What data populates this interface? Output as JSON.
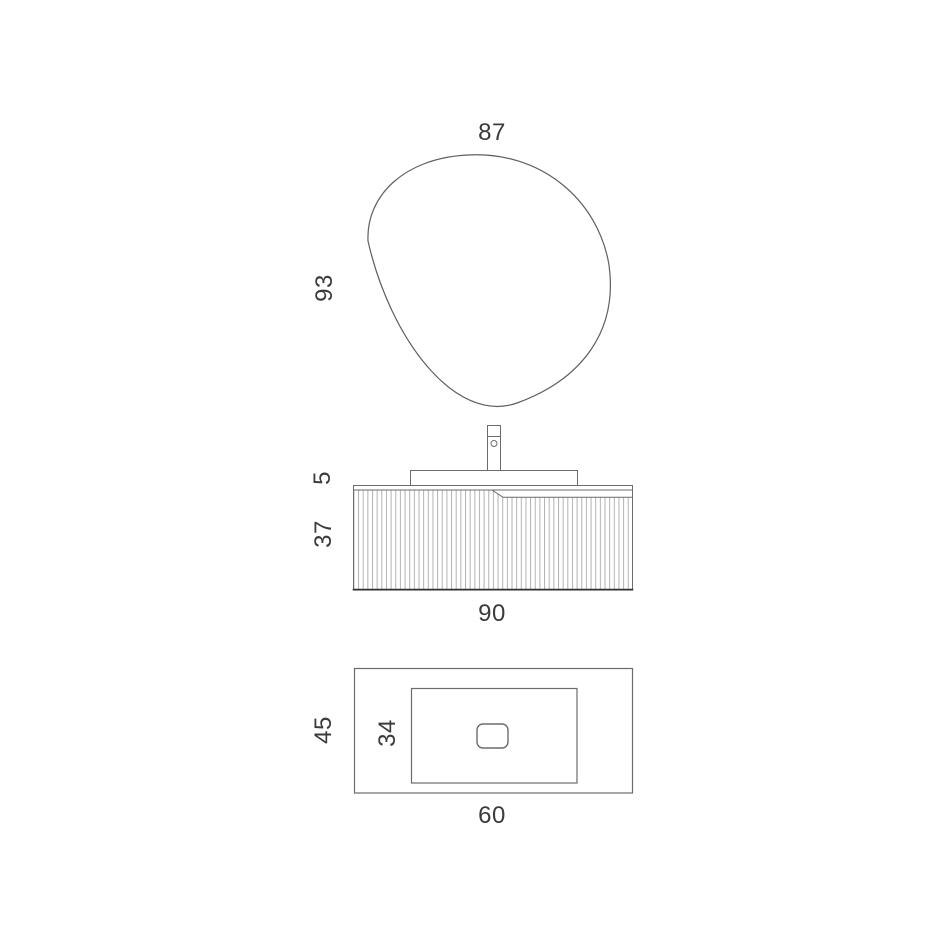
{
  "document": {
    "type": "furniture-dimension-diagram",
    "subject": "bathroom vanity set: pebble mirror, fluted wall-hung cabinet with basin and faucet, washbasin plan view",
    "units_shown": "none (numeric dimension labels only)"
  },
  "colors": {
    "background": "#ffffff",
    "outline": "#6b6b6b",
    "mirror_outline": "#5f5f5f",
    "cabinet_bottom_edge": "#2f2f2f",
    "flute_line": "#b3b3b3",
    "dimension_text": "#3b3b3b"
  },
  "views": {
    "mirror_front": {
      "label": "mirror front view",
      "shape": "organic pebble outline",
      "dimensions": {
        "width": "87",
        "height": "93"
      }
    },
    "vanity_front": {
      "label": "vanity front view",
      "features": [
        "faucet with aerator hole",
        "countertop deck",
        "fluted drawer front",
        "recessed handle groove"
      ],
      "dimensions": {
        "countertop_height": "5",
        "cabinet_height": "37",
        "cabinet_width": "90"
      }
    },
    "washbasin_plan": {
      "label": "washbasin top (plan) view",
      "features": [
        "outer counter rectangle",
        "inner basin rectangle",
        "rounded drain"
      ],
      "dimensions": {
        "outer_depth": "45",
        "basin_depth": "34",
        "outer_width": "60"
      }
    }
  }
}
